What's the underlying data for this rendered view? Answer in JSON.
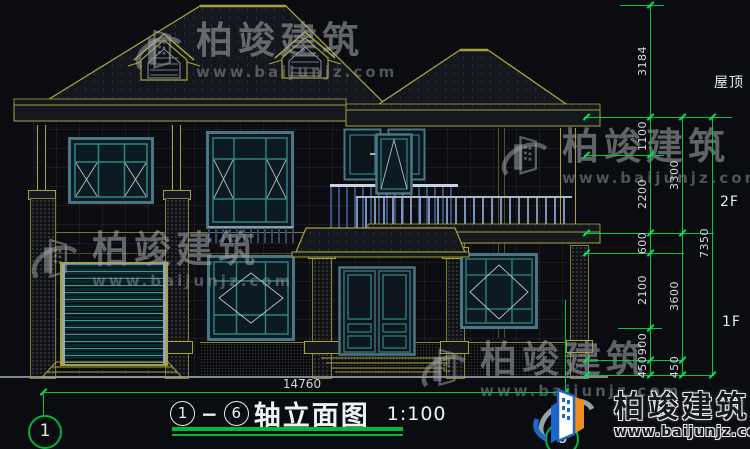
{
  "drawing": {
    "levels": {
      "roof": "屋顶",
      "f2": "2F",
      "f1": "1F"
    },
    "dims_inner": [
      "3184",
      "1100",
      "2200",
      "600",
      "2100",
      "900",
      "450"
    ],
    "dims_middle": [
      "3300",
      "3600",
      "450"
    ],
    "dims_outer": [
      "7350"
    ],
    "overall_width": "14760",
    "axis_left": "1",
    "axis_right": "6",
    "title": {
      "prefix_axis": "1",
      "dash": "−",
      "suffix_axis": "6",
      "name": "轴立面图",
      "scale": "1:100"
    }
  },
  "watermark": {
    "brand": "柏竣建筑",
    "url": "www.baijunjz.com"
  },
  "footer_logo": {
    "brand": "柏竣建筑",
    "url": "www.baijunjz.com"
  },
  "colors": {
    "dim_green": "#00c840",
    "cad_olive": "#a8a23c",
    "window_teal": "#2e8585",
    "background": "#0a0c12"
  }
}
